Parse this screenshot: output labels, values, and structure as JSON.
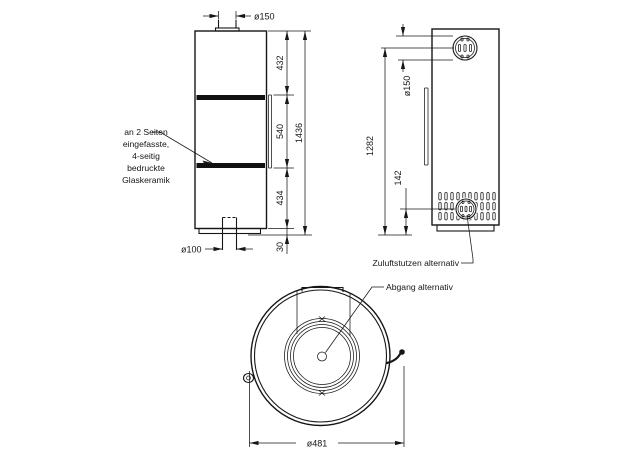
{
  "drawing": {
    "title": "stove-dimension-drawing",
    "front_view": {
      "flue_diameter_label": "ø150",
      "dim_top_section": "432",
      "dim_glass_section": "540",
      "dim_lower_section": "434",
      "dim_total_height": "1436",
      "dim_base_gap": "30",
      "air_pipe_diameter_label": "ø100",
      "glass_note_lines": [
        "an 2 Seiten",
        "eingefasste,",
        "4-seitig",
        "bedruckte",
        "Glaskeramik"
      ]
    },
    "side_view": {
      "rear_flue_diameter_label": "ø150",
      "dim_flue_center_height": "1282",
      "dim_air_inlet_center_height": "142",
      "air_inlet_note": "Zuluftstutzen alternativ"
    },
    "top_view": {
      "outlet_note": "Abgang alternativ",
      "dim_outer_diameter": "ø481"
    }
  }
}
